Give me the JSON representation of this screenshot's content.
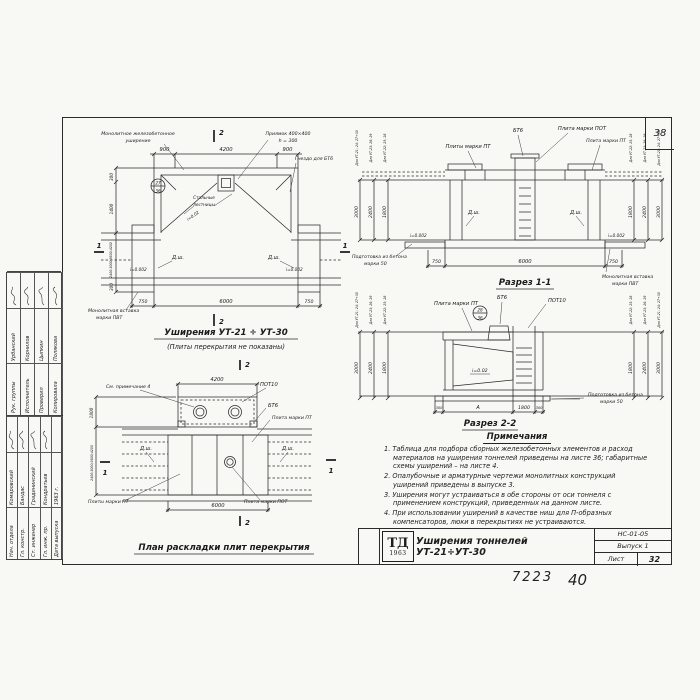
{
  "sheet": {
    "corner_number": "38",
    "handwritten_left": "7223",
    "handwritten_right": "40"
  },
  "common": {
    "dsh": "Д.ш.",
    "slope002": "i=0.002",
    "slope02": "i=0.02",
    "cut1": "1",
    "cut2": "2"
  },
  "ut_groups": [
    {
      "label": "Для УТ-21; 24; 27÷30",
      "value": "3000"
    },
    {
      "label": "Для УТ-23; 26; 29",
      "value": "2400"
    },
    {
      "label": "Для УТ-22; 25; 28",
      "value": "1800"
    }
  ],
  "plan_top": {
    "title": "Уширения УТ-21 ÷ УТ-30",
    "subtitle": "(Плиты перекрытия не показаны)",
    "lbl_widening1": "Монолитное железобетонное",
    "lbl_widening2": "уширение",
    "lbl_pit1": "Приямок 400×400",
    "lbl_pit2": "h = 300",
    "lbl_socket": "Гнездо для БТ6",
    "lbl_ladders1": "Стальные",
    "lbl_ladders2": "лестницы",
    "lbl_insert1": "Монолитная вставка",
    "lbl_insert2": "марки ПВТ",
    "detail_top": "27",
    "detail_bot": "36",
    "dims": {
      "top_l": "900",
      "top_c": "4200",
      "top_r": "900",
      "bot_l": "750",
      "bot_c": "6000",
      "bot_r": "750",
      "left_1": "300",
      "left_2": "1400",
      "left_var": "2400;3000;3600;4200",
      "left_3": "300"
    }
  },
  "section1": {
    "title": "Разрез 1-1",
    "lbl_pts": "Плиты марки ПТ",
    "lbl_bt6": "БТ6",
    "lbl_pot": "Плита марки ПОТ",
    "lbl_pt": "Плита марки ПТ",
    "prep1": "Подготовка из бетона",
    "prep2": "марки 50",
    "insert1": "Монолитная вставка",
    "insert2": "марки ПВТ",
    "dims": {
      "bot_l": "750",
      "bot_c": "6000",
      "bot_r": "750"
    }
  },
  "section2": {
    "title": "Разрез 2-2",
    "lbl_pt": "Плита марки ПТ",
    "lbl_bt6": "БТ6",
    "lbl_pot10": "ПОТ10",
    "detail_top": "28",
    "detail_bot": "36",
    "prep1": "Подготовка из бетона",
    "prep2": "марки 50",
    "dims": {
      "b1": "300",
      "b2": "А",
      "b3": "1800",
      "b4": "300"
    }
  },
  "plan_bottom": {
    "title": "План раскладки плит перекрытия",
    "lbl_note4": "См. примечание 4",
    "lbl_pot10": "ПОТ10",
    "lbl_bt6": "БТ6",
    "lbl_pt": "Плита марки ПТ",
    "lbl_pts": "Плиты марки ПТ",
    "lbl_pot": "Плита марки ПОТ",
    "dims": {
      "top": "4200",
      "bot": "6000",
      "left1": "1800",
      "left_var": "2400;3000;3600;4200"
    }
  },
  "notes": {
    "title": "Примечания",
    "items": [
      "1. Таблица для подбора сборных железобетонных элементов и расход материалов на уширения тоннелей приведены на листе 36; габаритные схемы уширений – на листе 4.",
      "2. Опалубочные и арматурные чертежи монолитных конструкций уширений приведены в выпуске 3.",
      "3. Уширения могут устраиваться в обе стороны от оси тоннеля с применением конструкций, приведенных на данном листе.",
      "4. При использовании уширений в качестве ниш для П-образных компенсаторов, люки в перекрытиях не устраиваются."
    ]
  },
  "titleblock": {
    "logo_top": "ТД",
    "logo_bottom": "1963",
    "title": "Уширения тоннелей УТ-21÷УТ-30",
    "code": "НС-01-05",
    "issue": "Выпуск 1",
    "sheet_label": "Лист",
    "sheet_number": "32"
  },
  "stamp": {
    "top_rows": [
      {
        "role": "Рук. группы",
        "name": "Урбанский"
      },
      {
        "role": "Исполнитель",
        "name": "Корнилов"
      },
      {
        "role": "Проверил",
        "name": "Цыпкин"
      },
      {
        "role": "Копировала",
        "name": "Полякова"
      }
    ],
    "bottom_rows": [
      {
        "role": "Нач. отдела",
        "name": "Комаровский"
      },
      {
        "role": "Гл. констр.",
        "name": "Бандас"
      },
      {
        "role": "Ст. инженер",
        "name": "Градининский"
      },
      {
        "role": "Гл. инж. пр.",
        "name": "Кондратьев"
      },
      {
        "role": "Дата выпуска",
        "name": "1963 г."
      }
    ]
  }
}
